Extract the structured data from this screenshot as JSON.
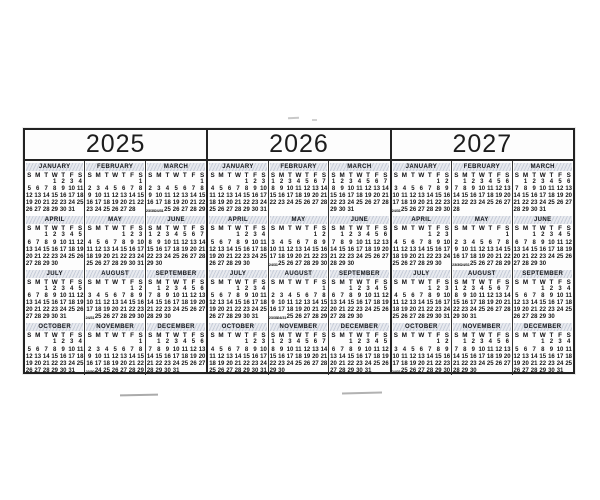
{
  "colors": {
    "page_bg": "#ffffff",
    "border": "#222222",
    "text": "#161616",
    "band": "#e8eaef",
    "band_stripe": "#c7cdd9",
    "scan_mark": "#ababab"
  },
  "day_headers": [
    "S",
    "M",
    "T",
    "W",
    "T",
    "F",
    "S"
  ],
  "years": [
    {
      "label": "2025",
      "months": [
        {
          "name": "JANUARY",
          "rows": [
            ". . . 1 2 3 4",
            "5 6 7 8 9 10 11",
            "12 13 14 15 16 17 18",
            "19 20 21 22 23 24 25",
            "26 27 28 29 30 31 ."
          ]
        },
        {
          "name": "FEBRUARY",
          "rows": [
            ". . . . . . 1",
            "2 3 4 5 6 7 8",
            "9 10 11 12 13 14 15",
            "16 17 18 19 20 21 22",
            "23 24 25 26 27 28 ."
          ]
        },
        {
          "name": "MARCH",
          "rows": [
            ". . . . . . 1",
            "2 3 4 5 6 7 8",
            "9 10 11 12 13 14 15",
            "16 17 18 19 20 21 22",
            "23/30 24/31 25 26 27 28 29"
          ]
        },
        {
          "name": "APRIL",
          "rows": [
            ". . 1 2 3 4 5",
            "6 7 8 9 10 11 12",
            "13 14 15 16 17 18 19",
            "20 21 22 23 24 25 26",
            "27 28 29 30 . . ."
          ]
        },
        {
          "name": "MAY",
          "rows": [
            ". . . . 1 2 3",
            "4 5 6 7 8 9 10",
            "11 12 13 14 15 16 17",
            "18 19 20 21 22 23 24",
            "25 26 27 28 29 30 31"
          ]
        },
        {
          "name": "JUNE",
          "rows": [
            "1 2 3 4 5 6 7",
            "8 9 10 11 12 13 14",
            "15 16 17 18 19 20 21",
            "22 23 24 25 26 27 28",
            "29 30 . . . . ."
          ]
        },
        {
          "name": "JULY",
          "rows": [
            ". . 1 2 3 4 5",
            "6 7 8 9 10 11 12",
            "13 14 15 16 17 18 19",
            "20 21 22 23 24 25 26",
            "27 28 29 30 31 . ."
          ]
        },
        {
          "name": "AUGUST",
          "rows": [
            ". . . . . 1 2",
            "3 4 5 6 7 8 9",
            "10 11 12 13 14 15 16",
            "17 18 19 20 21 22 23",
            "24/31 25 26 27 28 29 30"
          ]
        },
        {
          "name": "SEPTEMBER",
          "rows": [
            ". 1 2 3 4 5 6",
            "7 8 9 10 11 12 13",
            "14 15 16 17 18 19 20",
            "21 22 23 24 25 26 27",
            "28 29 30 . . . ."
          ]
        },
        {
          "name": "OCTOBER",
          "rows": [
            ". . . 1 2 3 4",
            "5 6 7 8 9 10 11",
            "12 13 14 15 16 17 18",
            "19 20 21 22 23 24 25",
            "26 27 28 29 30 31 ."
          ]
        },
        {
          "name": "NOVEMBER",
          "rows": [
            ". . . . . . 1",
            "2 3 4 5 6 7 8",
            "9 10 11 12 13 14 15",
            "16 17 18 19 20 21 22",
            "23/30 24 25 26 27 28 29"
          ]
        },
        {
          "name": "DECEMBER",
          "rows": [
            ". 1 2 3 4 5 6",
            "7 8 9 10 11 12 13",
            "14 15 16 17 18 19 20",
            "21 22 23 24 25 26 27",
            "28 29 30 31 . . ."
          ]
        }
      ]
    },
    {
      "label": "2026",
      "months": [
        {
          "name": "JANUARY",
          "rows": [
            ". . . . 1 2 3",
            "4 5 6 7 8 9 10",
            "11 12 13 14 15 16 17",
            "18 19 20 21 22 23 24",
            "25 26 27 28 29 30 31"
          ]
        },
        {
          "name": "FEBRUARY",
          "rows": [
            "1 2 3 4 5 6 7",
            "8 9 10 11 12 13 14",
            "15 16 17 18 19 20 21",
            "22 23 24 25 26 27 28",
            ". . . . . . ."
          ]
        },
        {
          "name": "MARCH",
          "rows": [
            "1 2 3 4 5 6 7",
            "8 9 10 11 12 13 14",
            "15 16 17 18 19 20 21",
            "22 23 24 25 26 27 28",
            "29 30 31 . . . ."
          ]
        },
        {
          "name": "APRIL",
          "rows": [
            ". . . 1 2 3 4",
            "5 6 7 8 9 10 11",
            "12 13 14 15 16 17 18",
            "19 20 21 22 23 24 25",
            "26 27 28 29 30 . ."
          ]
        },
        {
          "name": "MAY",
          "rows": [
            ". . . . . 1 2",
            "3 4 5 6 7 8 9",
            "10 11 12 13 14 15 16",
            "17 18 19 20 21 22 23",
            "24/31 25 26 27 28 29 30"
          ]
        },
        {
          "name": "JUNE",
          "rows": [
            ". 1 2 3 4 5 6",
            "7 8 9 10 11 12 13",
            "14 15 16 17 18 19 20",
            "21 22 23 24 25 26 27",
            "28 29 30 . . . ."
          ]
        },
        {
          "name": "JULY",
          "rows": [
            ". . . 1 2 3 4",
            "5 6 7 8 9 10 11",
            "12 13 14 15 16 17 18",
            "19 20 21 22 23 24 25",
            "26 27 28 29 30 31 ."
          ]
        },
        {
          "name": "AUGUST",
          "rows": [
            ". . . . . . 1",
            "2 3 4 5 6 7 8",
            "9 10 11 12 13 14 15",
            "16 17 18 19 20 21 22",
            "23/30 24/31 25 26 27 28 29"
          ]
        },
        {
          "name": "SEPTEMBER",
          "rows": [
            ". . 1 2 3 4 5",
            "6 7 8 9 10 11 12",
            "13 14 15 16 17 18 19",
            "20 21 22 23 24 25 26",
            "27 28 29 30 . . ."
          ]
        },
        {
          "name": "OCTOBER",
          "rows": [
            ". . . . 1 2 3",
            "4 5 6 7 8 9 10",
            "11 12 13 14 15 16 17",
            "18 19 20 21 22 23 24",
            "25 26 27 28 29 30 31"
          ]
        },
        {
          "name": "NOVEMBER",
          "rows": [
            "1 2 3 4 5 6 7",
            "8 9 10 11 12 13 14",
            "15 16 17 18 19 20 21",
            "22 23 24 25 26 27 28",
            "29 30 . . . . ."
          ]
        },
        {
          "name": "DECEMBER",
          "rows": [
            ". . 1 2 3 4 5",
            "6 7 8 9 10 11 12",
            "13 14 15 16 17 18 19",
            "20 21 22 23 24 25 26",
            "27 28 29 30 31 . ."
          ]
        }
      ]
    },
    {
      "label": "2027",
      "months": [
        {
          "name": "JANUARY",
          "rows": [
            ". . . . . 1 2",
            "3 4 5 6 7 8 9",
            "10 11 12 13 14 15 16",
            "17 18 19 20 21 22 23",
            "24/31 25 26 27 28 29 30"
          ]
        },
        {
          "name": "FEBRUARY",
          "rows": [
            ". 1 2 3 4 5 6",
            "7 8 9 10 11 12 13",
            "14 15 16 17 18 19 20",
            "21 22 23 24 25 26 27",
            "28 . . . . . ."
          ]
        },
        {
          "name": "MARCH",
          "rows": [
            ". 1 2 3 4 5 6",
            "7 8 9 10 11 12 13",
            "14 15 16 17 18 19 20",
            "21 22 23 24 25 26 27",
            "28 29 30 31 . . ."
          ]
        },
        {
          "name": "APRIL",
          "rows": [
            ". . . . 1 2 3",
            "4 5 6 7 8 9 10",
            "11 12 13 14 15 16 17",
            "18 19 20 21 22 23 24",
            "25 26 27 28 29 30 ."
          ]
        },
        {
          "name": "MAY",
          "rows": [
            ". . . . . . 1",
            "2 3 4 5 6 7 8",
            "9 10 11 12 13 14 15",
            "16 17 18 19 20 21 22",
            "23/30 24/31 25 26 27 28 29"
          ]
        },
        {
          "name": "JUNE",
          "rows": [
            ". . 1 2 3 4 5",
            "6 7 8 9 10 11 12",
            "13 14 15 16 17 18 19",
            "20 21 22 23 24 25 26",
            "27 28 29 30 . . ."
          ]
        },
        {
          "name": "JULY",
          "rows": [
            ". . . . 1 2 3",
            "4 5 6 7 8 9 10",
            "11 12 13 14 15 16 17",
            "18 19 20 21 22 23 24",
            "25 26 27 28 29 30 31"
          ]
        },
        {
          "name": "AUGUST",
          "rows": [
            "1 2 3 4 5 6 7",
            "8 9 10 11 12 13 14",
            "15 16 17 18 19 20 21",
            "22 23 24 25 26 27 28",
            "29 30 31 . . . ."
          ]
        },
        {
          "name": "SEPTEMBER",
          "rows": [
            ". . . 1 2 3 4",
            "5 6 7 8 9 10 11",
            "12 13 14 15 16 17 18",
            "19 20 21 22 23 24 25",
            "26 27 28 29 30 . ."
          ]
        },
        {
          "name": "OCTOBER",
          "rows": [
            ". . . . . 1 2",
            "3 4 5 6 7 8 9",
            "10 11 12 13 14 15 16",
            "17 18 19 20 21 22 23",
            "24/31 25 26 27 28 29 30"
          ]
        },
        {
          "name": "NOVEMBER",
          "rows": [
            ". 1 2 3 4 5 6",
            "7 8 9 10 11 12 13",
            "14 15 16 17 18 19 20",
            "21 22 23 24 25 26 27",
            "28 29 30 . . . ."
          ]
        },
        {
          "name": "DECEMBER",
          "rows": [
            ". . . 1 2 3 4",
            "5 6 7 8 9 10 11",
            "12 13 14 15 16 17 18",
            "19 20 21 22 23 24 25",
            "26 27 28 29 30 31 ."
          ]
        }
      ]
    }
  ]
}
